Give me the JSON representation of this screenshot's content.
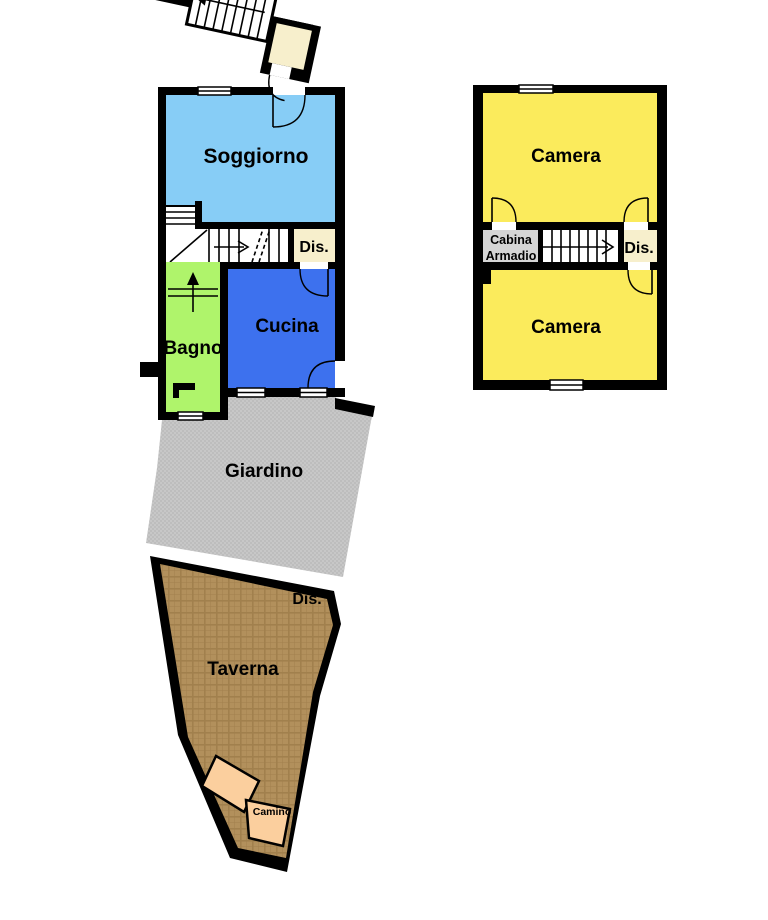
{
  "title": "Floor plan",
  "colors": {
    "wall": "#000000",
    "background": "#ffffff",
    "window": "#ffffff",
    "arrow": "#EC1C24"
  },
  "entrance": {
    "arrow_icon": "down-arrow",
    "color": "#EC1C24"
  },
  "rooms": {
    "soggiorno": {
      "label": "Soggiorno",
      "color": "#87CDF6"
    },
    "dis_ground": {
      "label": "Dis.",
      "color": "#F7EFCC"
    },
    "cucina": {
      "label": "Cucina",
      "color": "#3D71EE"
    },
    "bagno": {
      "label": "Bagno",
      "color": "#AFF46B"
    },
    "giardino": {
      "label": "Giardino",
      "color": "#C7C7C7",
      "texture_color": "#BDBDBD"
    },
    "taverna": {
      "label": "Taverna",
      "color": "#B2905C",
      "texture_color": "#A1804D"
    },
    "dis_taverna": {
      "label": "Dis.",
      "color": "#F7EFCC"
    },
    "camino": {
      "label": "Camino",
      "color": "#FBCF9E"
    },
    "camera_top": {
      "label": "Camera",
      "color": "#FBEB5C"
    },
    "camera_bottom": {
      "label": "Camera",
      "color": "#FBEB5C"
    },
    "cabina_armadio": {
      "label_line1": "Cabina",
      "label_line2": "Armadio",
      "color": "#D5D5D5"
    },
    "dis_first": {
      "label": "Dis.",
      "color": "#F7EFCC"
    }
  }
}
